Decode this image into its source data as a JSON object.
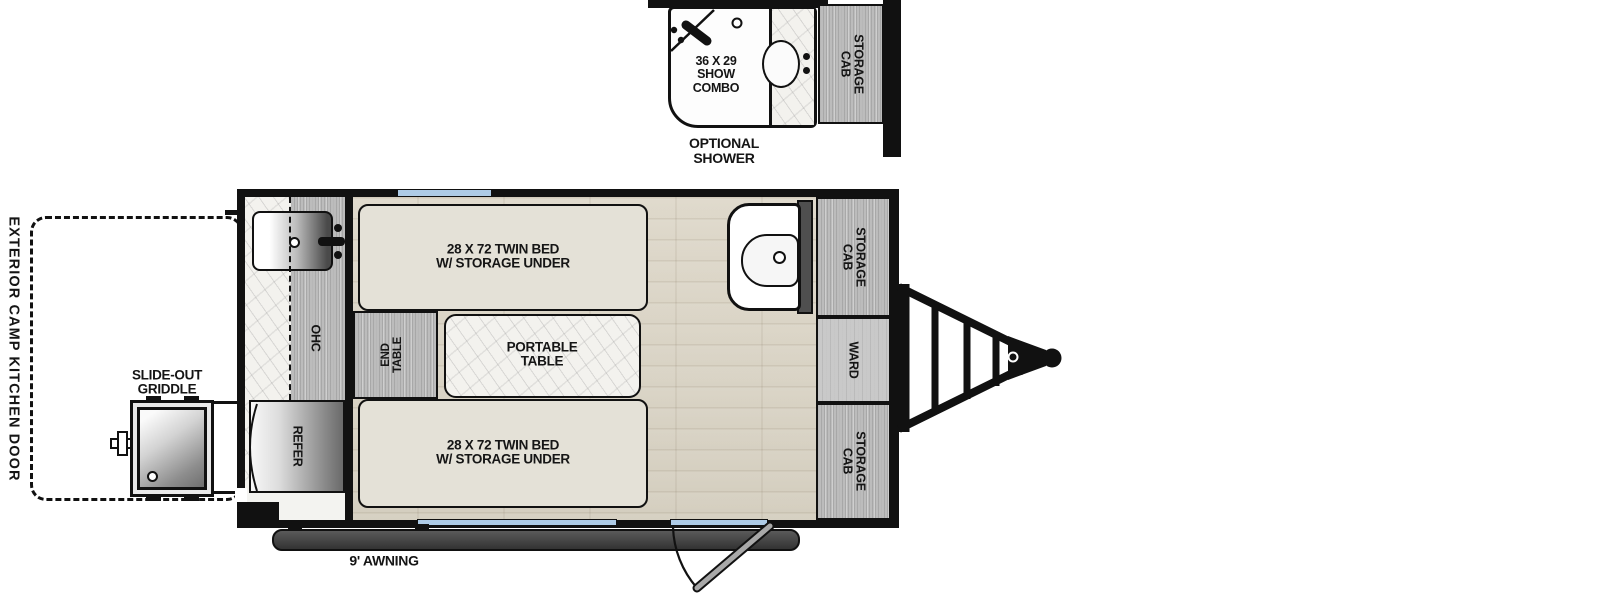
{
  "shower_section": {
    "size_label": [
      "36 X 29",
      "SHOW",
      "COMBO"
    ],
    "caption": [
      "OPTIONAL",
      "SHOWER"
    ],
    "storage_cab": [
      "STORAGE",
      "CAB"
    ]
  },
  "galley": {
    "ohc": "OHC",
    "refer": "REFER"
  },
  "main_room": {
    "bed_top": [
      "28 X 72 TWIN BED",
      "W/ STORAGE UNDER"
    ],
    "bed_bottom": [
      "28 X 72 TWIN BED",
      "W/ STORAGE UNDER"
    ],
    "portable_table": [
      "PORTABLE",
      "TABLE"
    ],
    "end_table": [
      "END",
      "TABLE"
    ]
  },
  "right_wall": {
    "storage_cab_top": [
      "STORAGE",
      "CAB"
    ],
    "ward": "WARD",
    "storage_cab_bottom": [
      "STORAGE",
      "CAB"
    ]
  },
  "exterior": {
    "camp_kitchen_door": "EXTERIOR CAMP KITCHEN DOOR",
    "slide_out_griddle": [
      "SLIDE-OUT",
      "GRIDDLE"
    ],
    "awning": "9' AWNING"
  },
  "colors": {
    "wall": "#111111",
    "window": "#aecbe6",
    "floor": "#d8d2c3",
    "cabinet": "#bcbcbc",
    "bed": "#e4e1d7",
    "awning_bar": "#3f3f3f"
  }
}
